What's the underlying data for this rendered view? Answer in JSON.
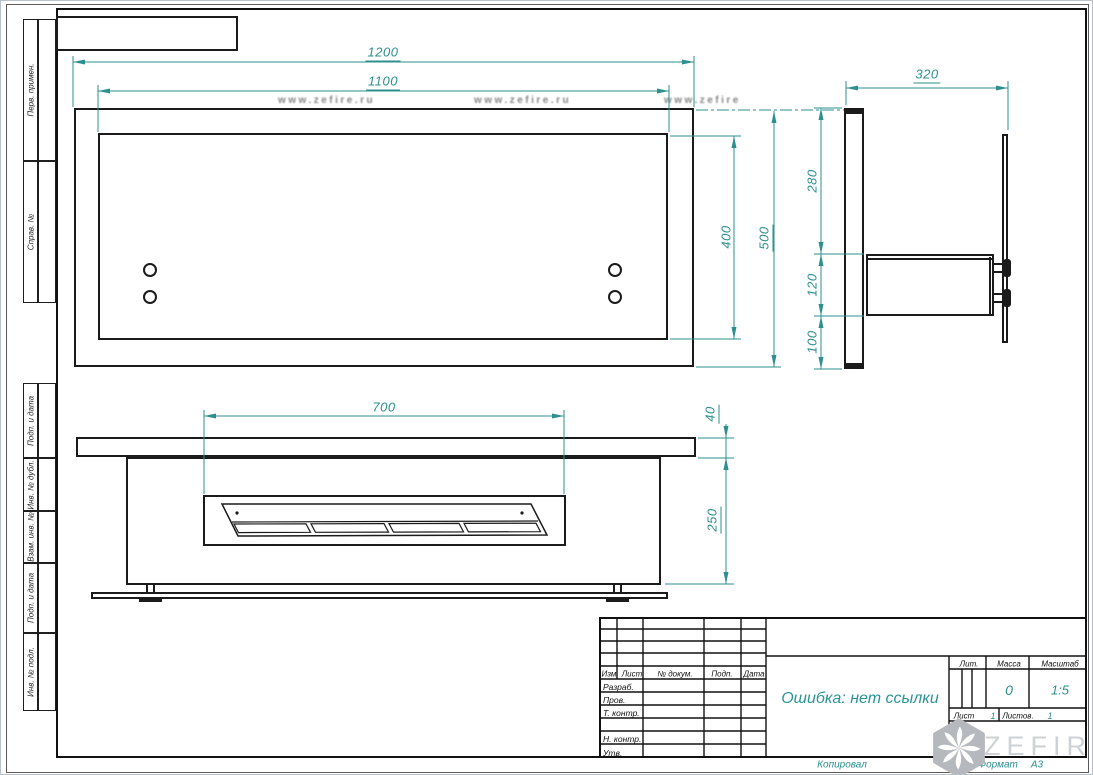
{
  "margin_strips": {
    "labels": [
      "Перв. примен.",
      "Справ. №",
      "Подп. и дата",
      "Инв. № дубл.",
      "Взам. инв. №",
      "Подп. и дата",
      "Инв. № подл."
    ]
  },
  "watermark": {
    "url": "www.zefire.ru",
    "brand": "ZEFIRE"
  },
  "dimensions": {
    "front_outer_width": "1200",
    "front_inner_width": "1100",
    "front_inner_height": "400",
    "front_outer_height": "500",
    "side_depth": "320",
    "side_upper_height": "280",
    "side_box_height": "120",
    "side_lower_height": "100",
    "bottom_burner_width": "700",
    "bottom_shelf_thickness": "40",
    "bottom_body_height": "250"
  },
  "title_block": {
    "revision_columns": [
      "Изм.",
      "Лист",
      "№ докум.",
      "Подп.",
      "Дата"
    ],
    "signature_labels": [
      "Разраб.",
      "Пров.",
      "Т. контр.",
      "Н. контр.",
      "Утв."
    ],
    "doc_title": "Ошибка: нет ссылки",
    "lit_label": "Лит.",
    "mass_label": "Масса",
    "mass_value": "0",
    "scale_label": "Масштаб",
    "scale_value": "1:5",
    "sheet_label": "Лист",
    "sheet_value": "1",
    "sheets_label": "Листов.",
    "sheets_value": "1",
    "copied_label": "Копировал",
    "format_label": "Формат",
    "format_value": "А3"
  },
  "colors": {
    "dimension_teal": "#2e8f8f",
    "line_black": "#1b1b1b",
    "logo_gray": "#b5b9be"
  }
}
